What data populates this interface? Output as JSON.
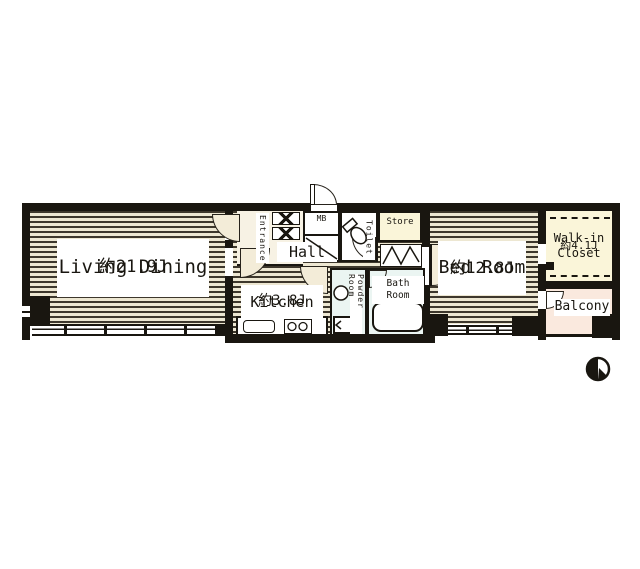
{
  "plan": {
    "rooms": {
      "living_dining": {
        "name": "Living Dining",
        "area": "約21.9J"
      },
      "kitchen": {
        "name": "Kitchen",
        "area": "約3.8J"
      },
      "hall": {
        "name": "Hall"
      },
      "entrance": {
        "name": "Entrance"
      },
      "mb": {
        "name": "MB"
      },
      "toilet": {
        "name": "Toilet"
      },
      "store": {
        "name": "Store"
      },
      "powder_room": {
        "name": "Powder Room"
      },
      "bath_room": {
        "name": "Bath\nRoom"
      },
      "bed_room": {
        "name": "Bed Room",
        "area": "約12.8J"
      },
      "walk_in_closet": {
        "name": "Walk-in\nCloset",
        "area": "約4.1J"
      },
      "balcony": {
        "name": "Balcony"
      }
    },
    "colors": {
      "wall": "#191610",
      "floor_stripe_light": "#EDE7D2",
      "floor_stripe_dark": "#3D372C",
      "closet_fill": "#FAF5D9",
      "balcony_fill": "#FAE9DE",
      "wet_area_fill": "#EBF5F2",
      "door_fill": "#F3ECD8",
      "label_fill": "#FFFFFF"
    },
    "icons": {
      "compass": "compass-north-icon",
      "toilet": "toilet-icon",
      "sink": "sink-icon",
      "bathtub": "bathtub-icon",
      "stove": "stove-icon",
      "kitchen_sink": "kitchen-sink-icon",
      "washing_machine": "washing-machine-icon"
    }
  }
}
